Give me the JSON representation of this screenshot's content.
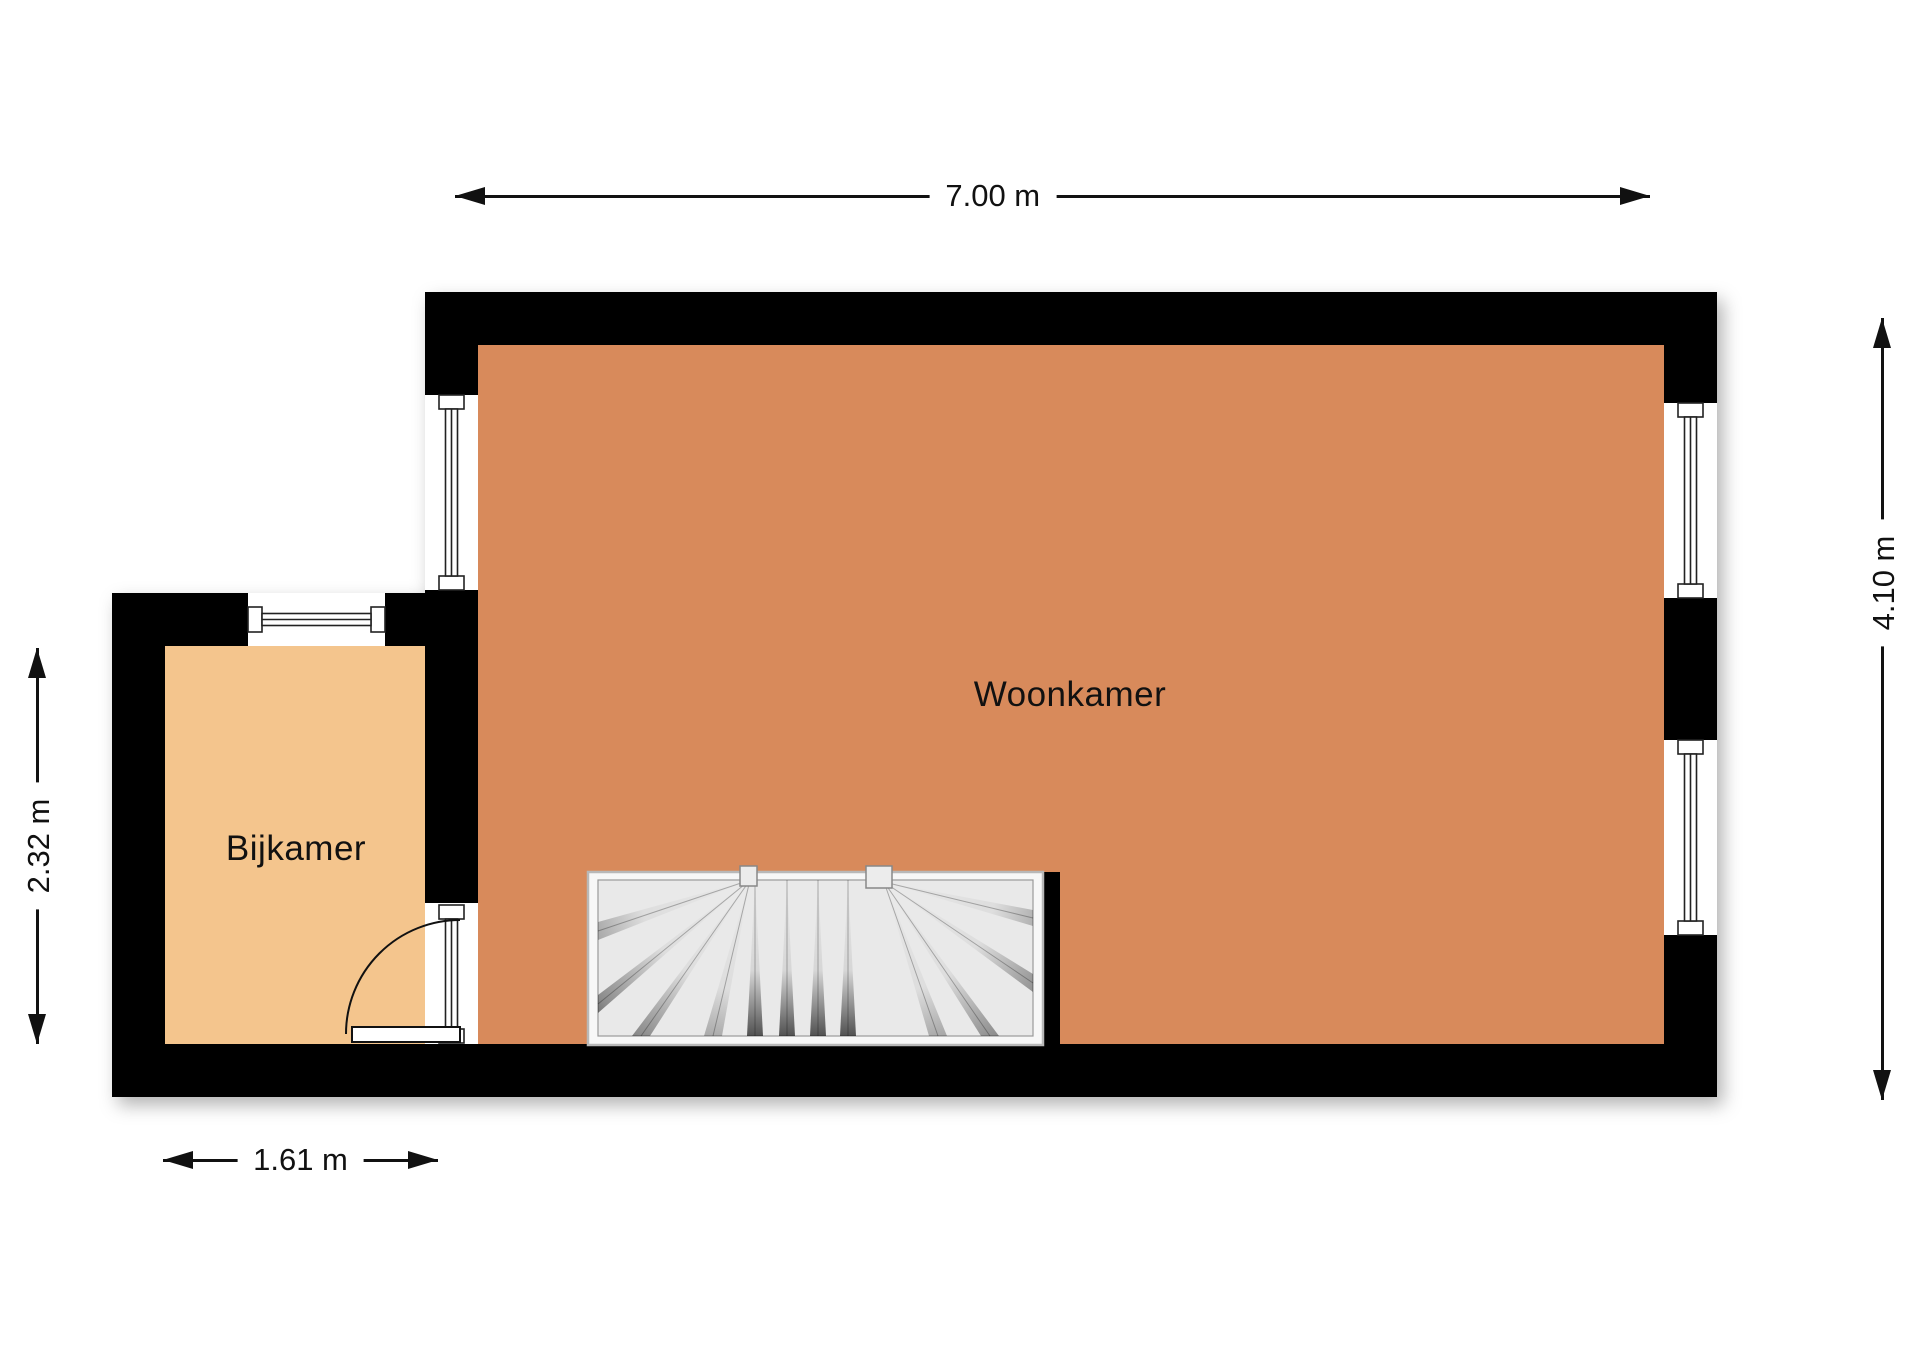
{
  "rooms": {
    "woonkamer": {
      "label": "Woonkamer",
      "floor_color": "#d88a5b"
    },
    "bijkamer": {
      "label": "Bijkamer",
      "floor_color": "#f4c58d"
    }
  },
  "dimensions": {
    "top": "7.00 m",
    "right": "4.10 m",
    "left": "2.32 m",
    "bottom": "1.61 m"
  },
  "colors": {
    "wall": "#000000",
    "background": "#ffffff",
    "dimension_text": "#111111",
    "stair_tread": "#e9e9e9"
  }
}
